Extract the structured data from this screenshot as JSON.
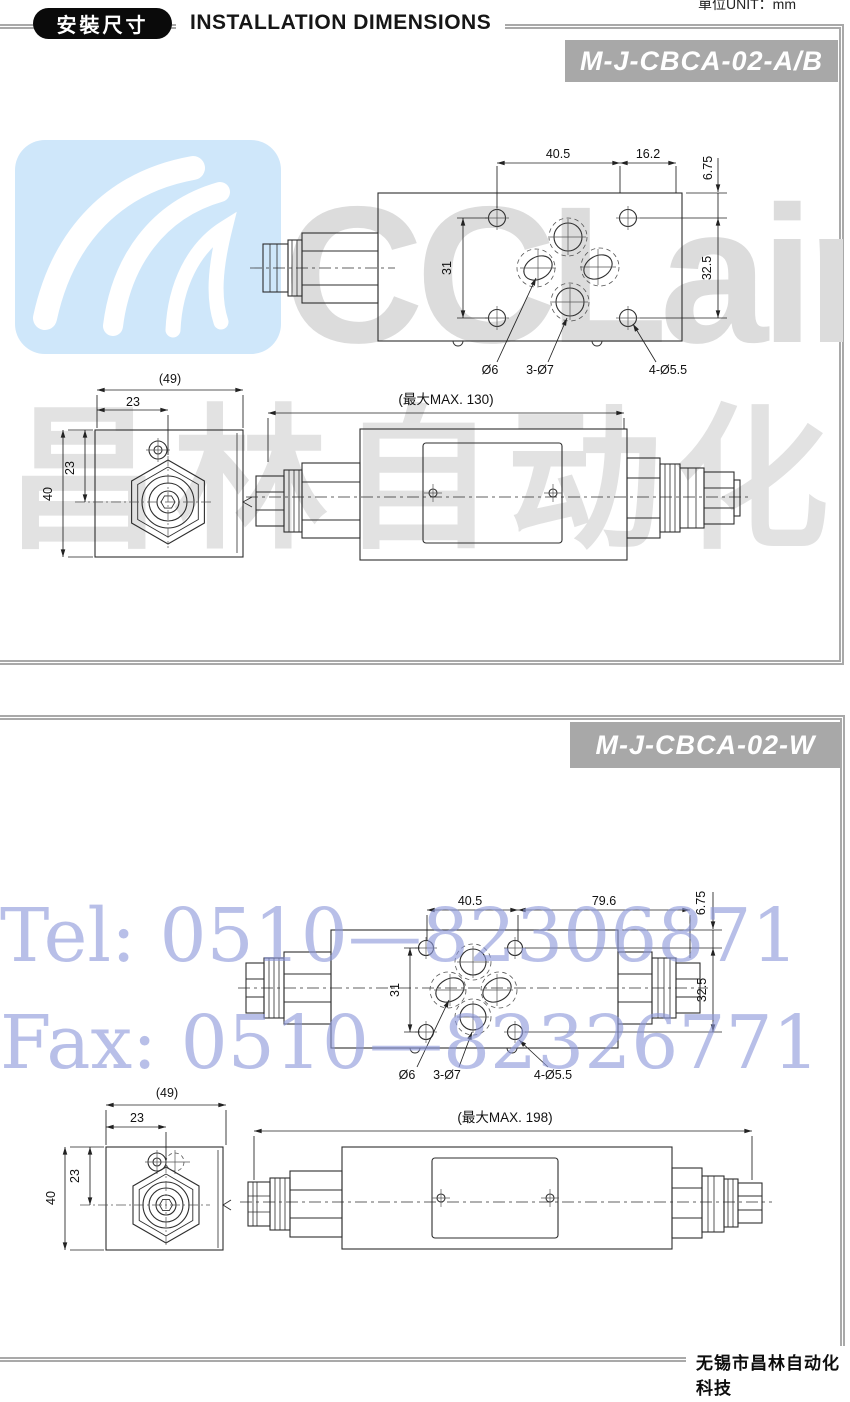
{
  "header": {
    "badge": "安裝尺寸",
    "title": "INSTALLATION DIMENSIONS",
    "unit": "單位UNIT：mm"
  },
  "watermarks": {
    "tel": "Tel: 0510—82306871",
    "fax": "Fax: 0510—82326771",
    "brand": "CCLair",
    "brand_cn": "昌林自动化"
  },
  "section1": {
    "model": "M-J-CBCA-02-A/B",
    "top_view": {
      "dim_a": "40.5",
      "dim_b": "16.2",
      "dim_c": "6.75",
      "dim_d": "32.5",
      "dim_e": "31",
      "hole_small": "Ø6",
      "hole_mid": "3-Ø7",
      "hole_corner": "4-Ø5.5"
    },
    "front_view": {
      "dim_max": "(最大MAX. 130)"
    },
    "end_view": {
      "dim_w": "(49)",
      "dim_x": "23",
      "dim_y": "23",
      "dim_h": "40"
    }
  },
  "section2": {
    "model": "M-J-CBCA-02-W",
    "top_view": {
      "dim_a": "40.5",
      "dim_b": "79.6",
      "dim_c": "6.75",
      "dim_d": "32.5",
      "dim_e": "31",
      "hole_small": "Ø6",
      "hole_mid": "3-Ø7",
      "hole_corner": "4-Ø5.5"
    },
    "front_view": {
      "dim_max": "(最大MAX. 198)"
    },
    "end_view": {
      "dim_w": "(49)",
      "dim_x": "23",
      "dim_y": "23",
      "dim_h": "40"
    }
  },
  "footer": {
    "company": "无锡市昌林自动化科技"
  }
}
